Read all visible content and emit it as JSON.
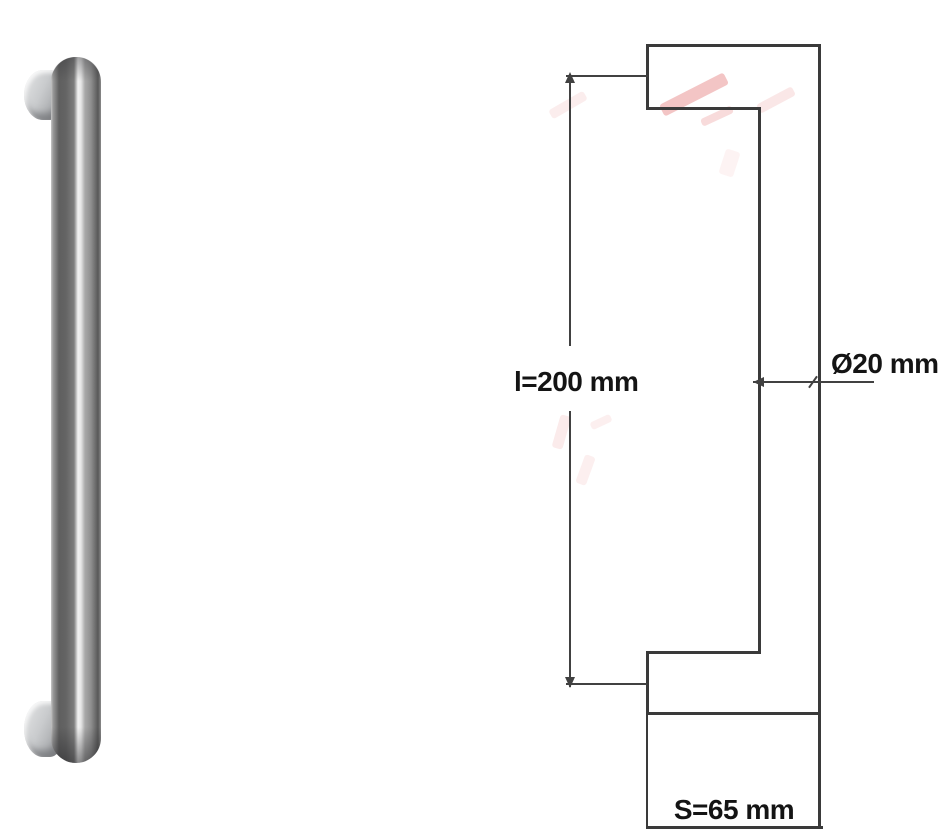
{
  "drawing": {
    "labels": {
      "length": "l=200 mm",
      "diameter": "Ø20 mm",
      "spacing": "S=65 mm"
    }
  },
  "colors": {
    "line": "#3a3a3a",
    "dimension_line": "#414141",
    "label_text": "#141414",
    "watermark_pink": "#e88f8f",
    "steel_dark": "#5f5f5f",
    "steel_mid": "#8f8f8f",
    "steel_highlight": "#f2f2f2",
    "mount_gray": "#c9cbcd",
    "background": "#ffffff"
  }
}
